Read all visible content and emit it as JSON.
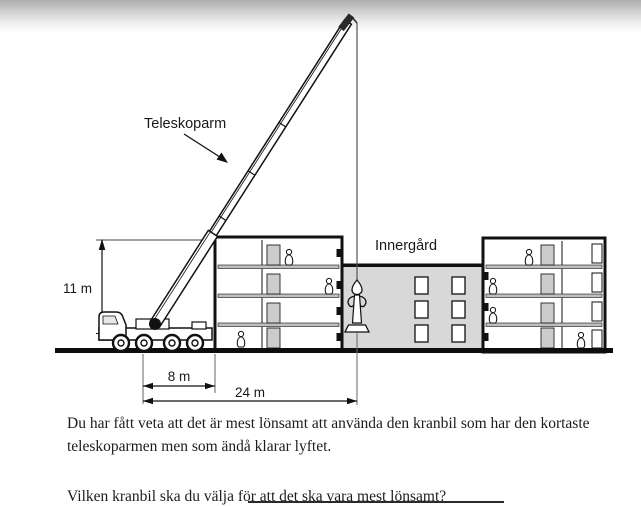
{
  "diagram": {
    "labels": {
      "arm": "Teleskoparm",
      "courtyard": "Innergård"
    },
    "dimensions": {
      "height": "11 m",
      "offset": "8 m",
      "span": "24 m"
    }
  },
  "body": {
    "paragraph_lines": [
      "Du har fått veta att det är mest lönsamt att använda den kranbil som har den kortaste",
      "teleskoparmen men som ändå klarar lyftet."
    ],
    "question": "Vilken kranbil ska du välja för att det ska vara mest lönsamt?"
  },
  "colors": {
    "ink": "#1a1a1a",
    "courtyard_fill": "#d8d8d8",
    "door_fill": "#cccccc",
    "slab_fill": "#bfbfbf",
    "gradient_top": "#aeaeae"
  }
}
